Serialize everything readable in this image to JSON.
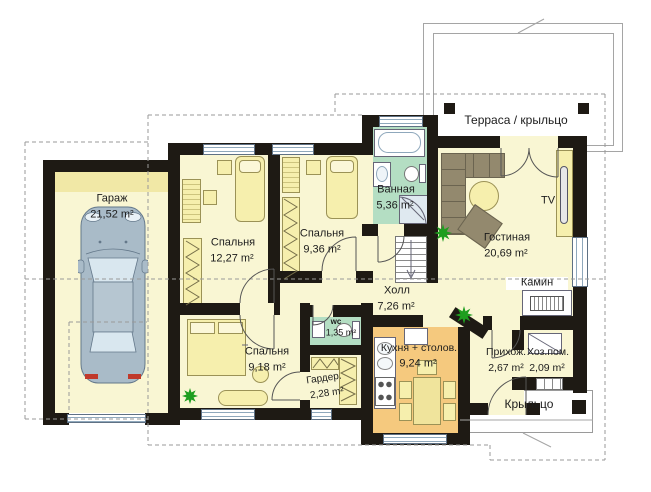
{
  "plan_title": "План первого этажа",
  "rooms": {
    "garage": {
      "name": "Гараж",
      "area": "21,52 m²"
    },
    "bedroom1": {
      "name": "Спальня",
      "area": "12,27 m²"
    },
    "bedroom2": {
      "name": "Спальня",
      "area": "9,36 m²"
    },
    "bathroom": {
      "name": "Ванная",
      "area": "5,36 m²"
    },
    "living": {
      "name": "Гостиная",
      "area": "20,69 m²"
    },
    "hall": {
      "name": "Холл",
      "area": "7,26 m²"
    },
    "wc": {
      "name": "wc",
      "area": "1,35 m²"
    },
    "bedroom3": {
      "name": "Спальня",
      "area": "9,18 m²"
    },
    "wardrobe": {
      "name": "Гардер.",
      "area": "2,28 m²"
    },
    "kitchen": {
      "name": "Кухня + столов.",
      "area": "9,24 m²"
    },
    "entry": {
      "name": "Прихож.",
      "area": "2,67 m²"
    },
    "utility": {
      "name": "Хоз.пом.",
      "area": "2,09 m²"
    },
    "terrace": {
      "name": "Терраса / крыльцо"
    },
    "porch": {
      "name": "Крыльцо"
    }
  },
  "annotations": {
    "tv": "TV",
    "fireplace": "Камин"
  },
  "colors": {
    "wall": "#1e1a14",
    "floor": "#f9f6d3",
    "wet_zone": "#b4dec3",
    "kitchen_floor": "#f5c97e",
    "furniture": "#f6efad",
    "sofa": "#93896e",
    "plant": "#1f9e1f"
  }
}
